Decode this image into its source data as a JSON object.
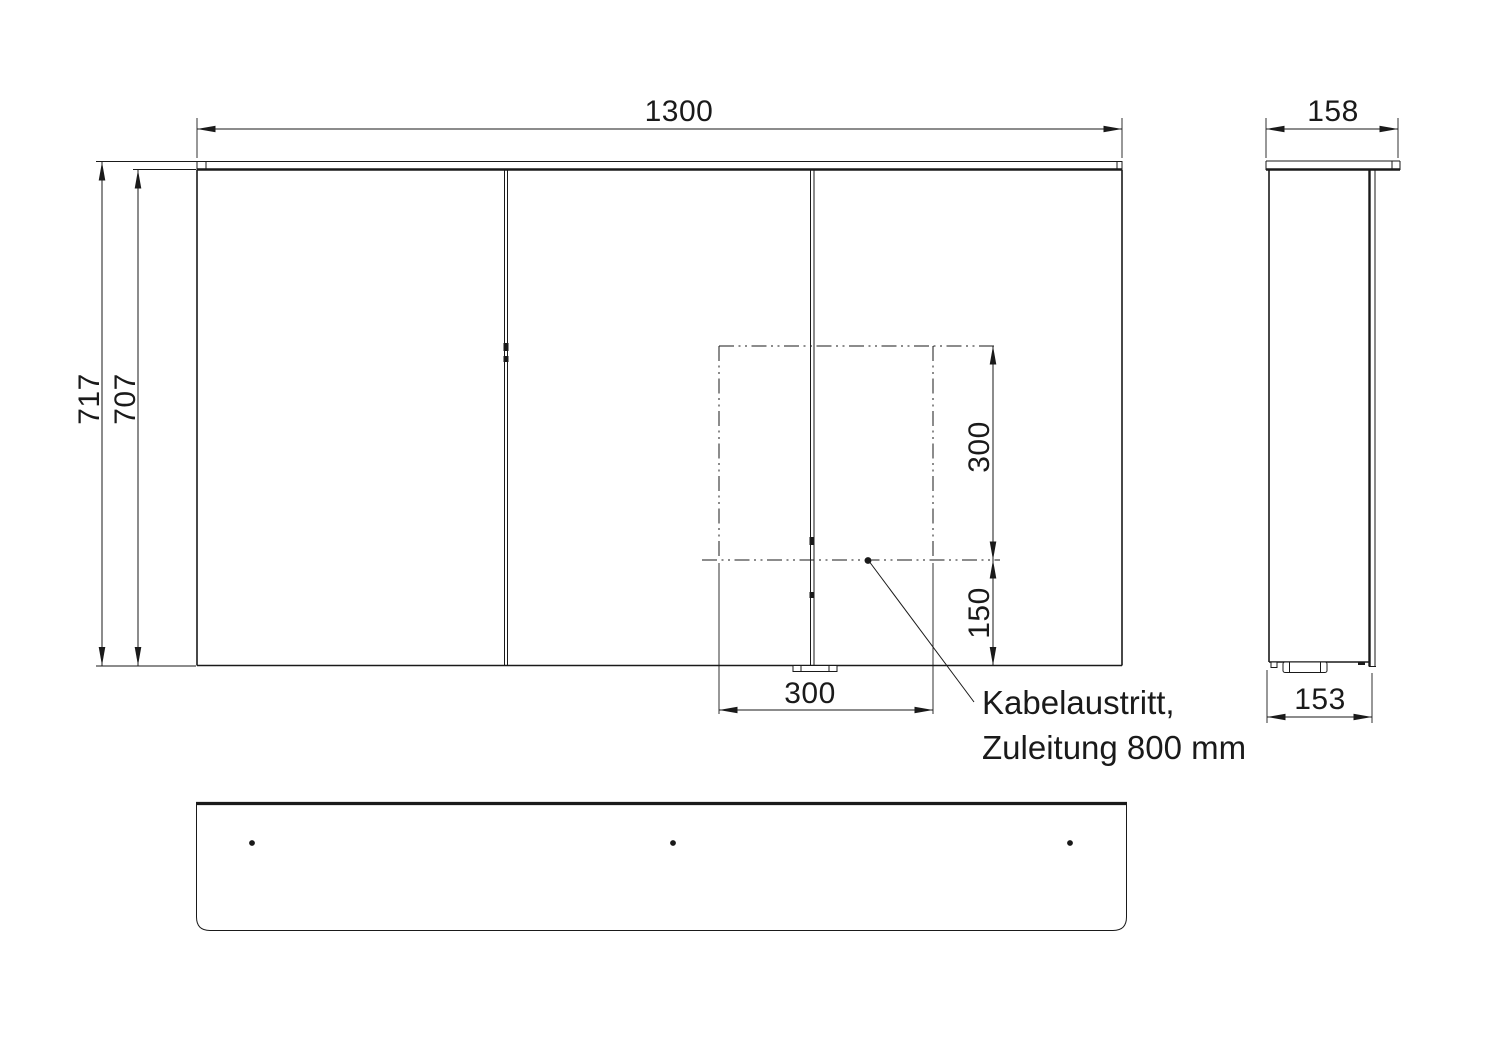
{
  "drawing": {
    "front_view": {
      "width_label": "1300",
      "height_total_label": "717",
      "height_door_label": "707",
      "cutout_width_label": "300",
      "cutout_height_label": "300",
      "cutout_offset_label": "150"
    },
    "side_view": {
      "depth_top_label": "158",
      "depth_bottom_label": "153"
    },
    "annotation": {
      "line1": "Kabelaustritt,",
      "line2": "Zuleitung 800 mm"
    },
    "colors": {
      "line": "#1a1a1a",
      "background": "#ffffff"
    }
  }
}
